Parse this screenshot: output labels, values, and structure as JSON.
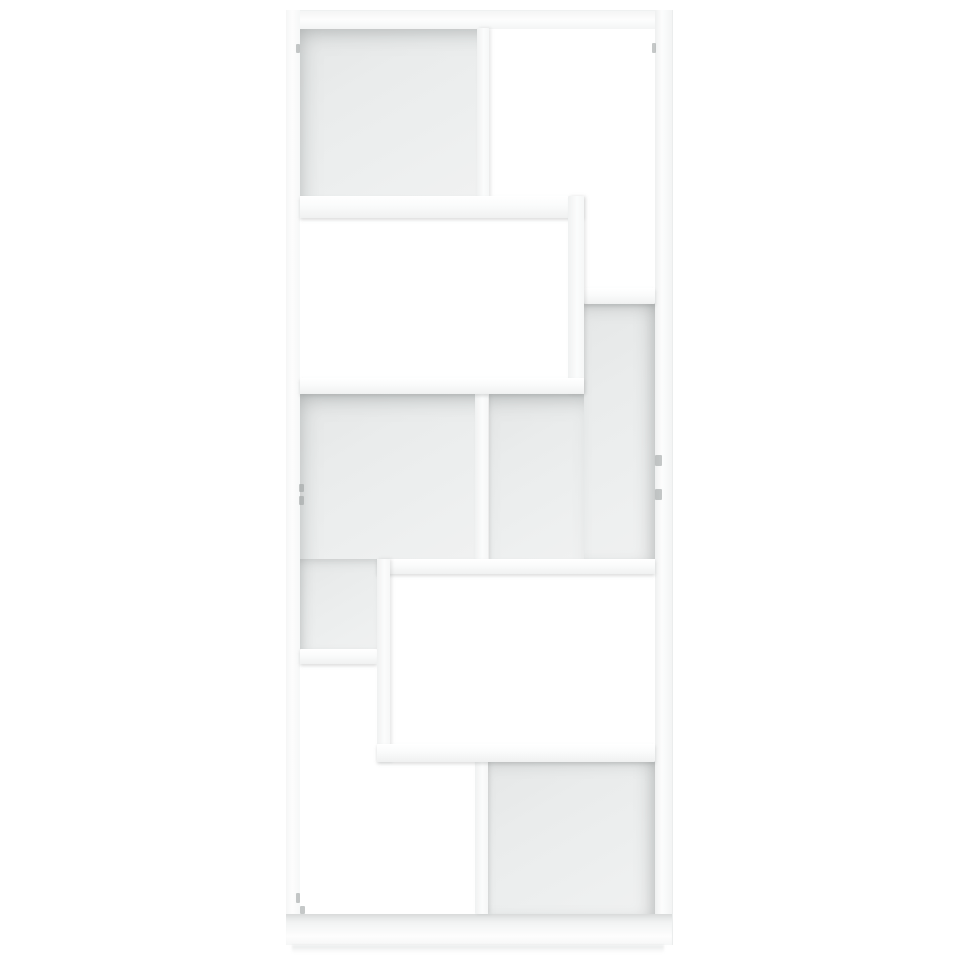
{
  "scene": {
    "type": "product-photo",
    "description": "Straight-on front view of a tall white freestanding book cabinet / display shelf with eight staggered cube compartments; some compartments have grey back panels, others are open through to the white background. No text appears in the image.",
    "background_color": "#ffffff",
    "object": {
      "name": "book-cabinet",
      "color_name": "white",
      "finish": "matte chipboard",
      "compartments_total": 8,
      "compartments_with_back_panel": 4,
      "compartments_open": 4,
      "frame_color": "#fbfcfc",
      "back_panel_color": "#eaecec",
      "shadow_color": "#acb1b1"
    }
  },
  "geometry": {
    "canvas": {
      "width": 960,
      "height": 960
    },
    "unit": {
      "x": 286,
      "y": 10,
      "width": 386,
      "height": 935
    },
    "regions": [
      {
        "name": "back-top-left",
        "type": "back",
        "shade": "tl",
        "x": 300,
        "y": 28,
        "w": 178,
        "h": 168
      },
      {
        "name": "back-right-upper",
        "type": "back",
        "shade": "tr",
        "x": 584,
        "y": 302,
        "w": 71,
        "h": 257
      },
      {
        "name": "back-mid-right",
        "type": "back",
        "shade": "top",
        "x": 489,
        "y": 394,
        "w": 95,
        "h": 165
      },
      {
        "name": "back-mid-left",
        "type": "back",
        "shade": "tl",
        "x": 300,
        "y": 394,
        "w": 175,
        "h": 165
      },
      {
        "name": "back-lower-left",
        "type": "back",
        "shade": "left",
        "x": 300,
        "y": 559,
        "w": 77,
        "h": 91
      },
      {
        "name": "back-bottom-right",
        "type": "back",
        "shade": "tr",
        "x": 488,
        "y": 757,
        "w": 167,
        "h": 157
      },
      {
        "name": "top-panel",
        "type": "panel_top",
        "x": 286,
        "y": 10,
        "w": 386,
        "h": 18
      },
      {
        "name": "left-side-panel",
        "type": "panel_left",
        "x": 286,
        "y": 10,
        "w": 14,
        "h": 935
      },
      {
        "name": "right-side-panel",
        "type": "panel_right",
        "x": 655,
        "y": 10,
        "w": 17,
        "h": 935
      },
      {
        "name": "bottom-panel",
        "type": "panel_bottom",
        "x": 286,
        "y": 914,
        "w": 386,
        "h": 31
      },
      {
        "name": "divider-top",
        "type": "divider",
        "x": 477,
        "y": 28,
        "w": 12,
        "h": 170
      },
      {
        "name": "divider-middle",
        "type": "divider",
        "x": 475,
        "y": 394,
        "w": 13,
        "h": 167
      },
      {
        "name": "divider-bottom",
        "type": "divider",
        "x": 475,
        "y": 757,
        "w": 13,
        "h": 157
      },
      {
        "name": "shelf-right",
        "type": "shelf",
        "x": 584,
        "y": 288,
        "w": 71,
        "h": 16
      },
      {
        "name": "shelf-left",
        "type": "shelf",
        "x": 300,
        "y": 649,
        "w": 77,
        "h": 15
      },
      {
        "name": "box1-top-shelf",
        "type": "shelf",
        "x": 300,
        "y": 196,
        "w": 284,
        "h": 22
      },
      {
        "name": "box1-right-side",
        "type": "side",
        "x": 568,
        "y": 196,
        "w": 16,
        "h": 198
      },
      {
        "name": "box1-bottom-shelf",
        "type": "shelf",
        "x": 300,
        "y": 378,
        "w": 284,
        "h": 16
      },
      {
        "name": "box2-top-shelf",
        "type": "shelf",
        "x": 377,
        "y": 559,
        "w": 278,
        "h": 15
      },
      {
        "name": "box2-left-side",
        "type": "side",
        "x": 377,
        "y": 559,
        "w": 13,
        "h": 203
      },
      {
        "name": "box2-bottom-shelf",
        "type": "shelf",
        "x": 377,
        "y": 744,
        "w": 278,
        "h": 18
      },
      {
        "name": "connector-mark",
        "type": "mark",
        "x": 296,
        "y": 44,
        "w": 4,
        "h": 9
      },
      {
        "name": "connector-mark",
        "type": "mark",
        "x": 652,
        "y": 43,
        "w": 4,
        "h": 10
      },
      {
        "name": "connector-mark",
        "type": "mark",
        "x": 655,
        "y": 455,
        "w": 7,
        "h": 11
      },
      {
        "name": "connector-mark",
        "type": "mark",
        "x": 655,
        "y": 489,
        "w": 7,
        "h": 11
      },
      {
        "name": "connector-mark",
        "type": "mark",
        "x": 299,
        "y": 484,
        "w": 5,
        "h": 8
      },
      {
        "name": "connector-mark",
        "type": "mark",
        "x": 299,
        "y": 496,
        "w": 5,
        "h": 9
      },
      {
        "name": "connector-mark",
        "type": "mark",
        "x": 296,
        "y": 893,
        "w": 4,
        "h": 10
      },
      {
        "name": "connector-mark",
        "type": "mark",
        "x": 300,
        "y": 906,
        "w": 5,
        "h": 8
      },
      {
        "name": "floor-shadow",
        "type": "shadow",
        "x": 292,
        "y": 945,
        "w": 372,
        "h": 8
      }
    ]
  }
}
